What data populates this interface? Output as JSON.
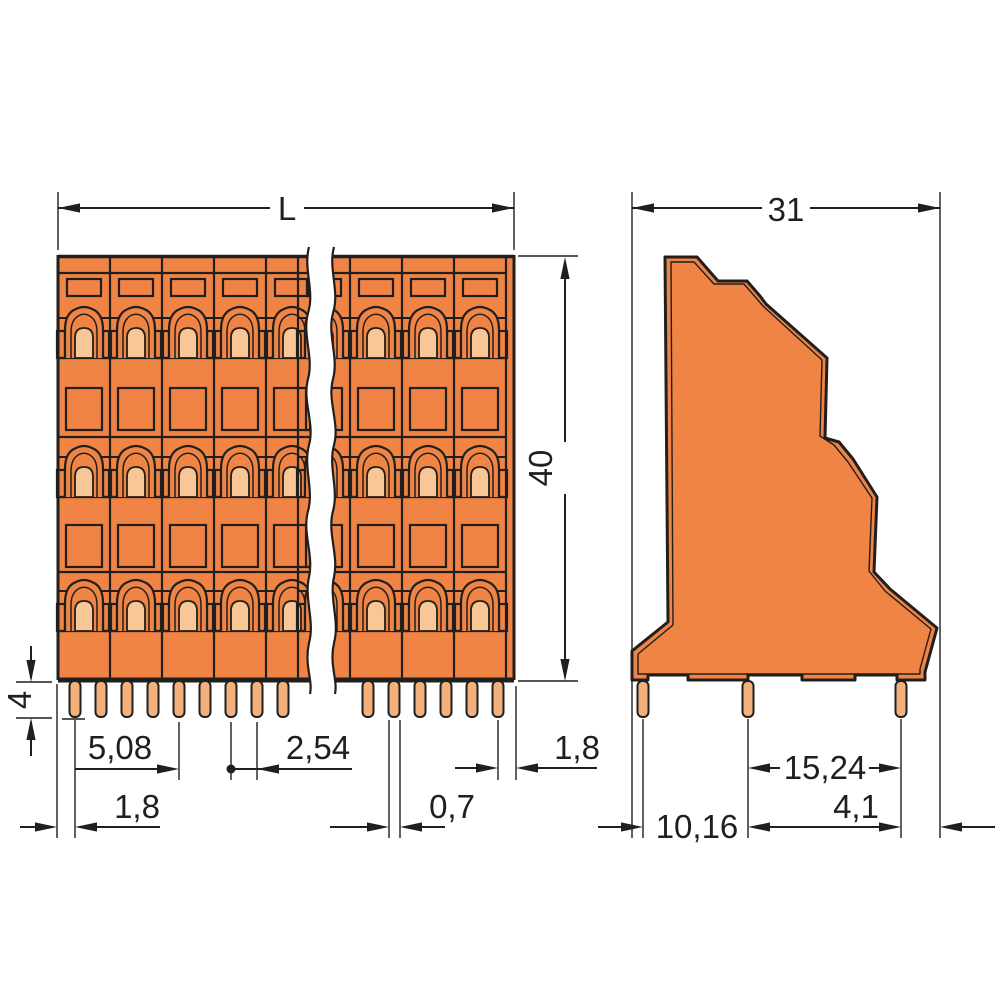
{
  "drawing": {
    "front_view": {
      "dim_overall_length": "L",
      "dim_height": "40",
      "dim_pin_length": "4",
      "dim_pole_pitch": "5,08",
      "dim_pin_pitch": "2,54",
      "dim_edge_to_pin_left": "1,8",
      "dim_pin_width": "0,7",
      "dim_edge_to_pin_right": "1,8"
    },
    "side_view": {
      "dim_depth": "31",
      "dim_pin_row_spacing": "15,24",
      "dim_pin_to_edge": "4,1",
      "dim_pin_row_offset": "10,16"
    },
    "colors": {
      "body_orange": "#EF8445",
      "light_orange": "#F8C795",
      "pin_copper": "#F1B07C",
      "line_dark": "#211F1D",
      "background": "#FFFFFF"
    }
  }
}
